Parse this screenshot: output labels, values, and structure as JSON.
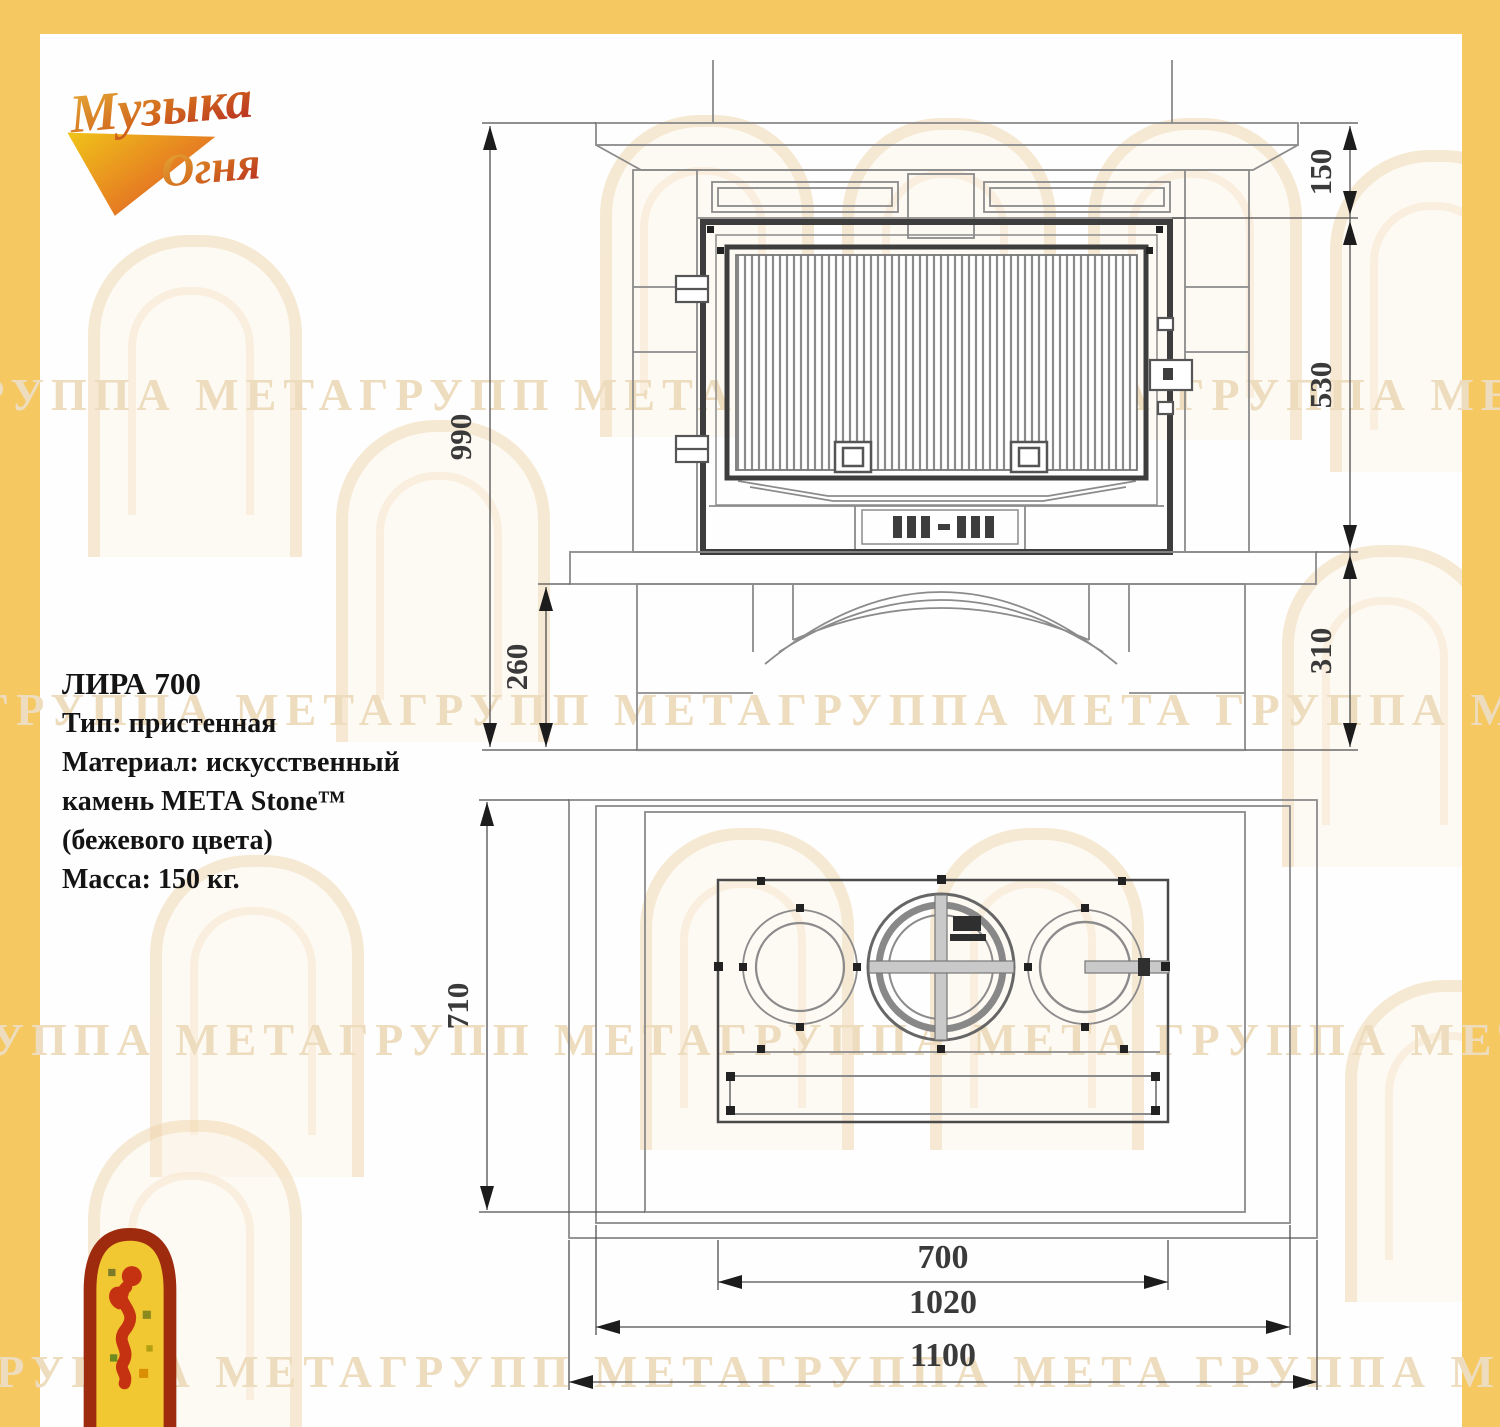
{
  "colors": {
    "frame": "#f5c862",
    "drawing_line": "#8b8b8b",
    "drawing_dark": "#3d3d3d",
    "dimension_text": "#3a3a3a",
    "watermark": "#eddcbd",
    "logo_gold": "#e2a32a",
    "logo_red": "#c0392b"
  },
  "brand": {
    "logo_line1": "Музыка",
    "logo_line2": "Огня"
  },
  "specs": {
    "title": "ЛИРА 700",
    "lines": [
      "Тип: пристенная",
      "Материал: искусственный",
      "камень МЕТА Stone™",
      "(бежевого цвета)",
      "Масса: 150 кг."
    ]
  },
  "drawing": {
    "front_view": {
      "total_height": "990",
      "plinth_height": "260",
      "mantel_offset": "150",
      "firebox_height": "530",
      "base_height": "310"
    },
    "top_view": {
      "depth": "710",
      "firebox_width": "700",
      "body_width": "1020",
      "total_width": "1100"
    }
  },
  "watermark": {
    "text": "ГРУППА МЕТАГРУПП МЕТАГРУППА МЕТА ГРУППА МЕТАГРУПП МЕТАГРУППА МЕТА"
  }
}
